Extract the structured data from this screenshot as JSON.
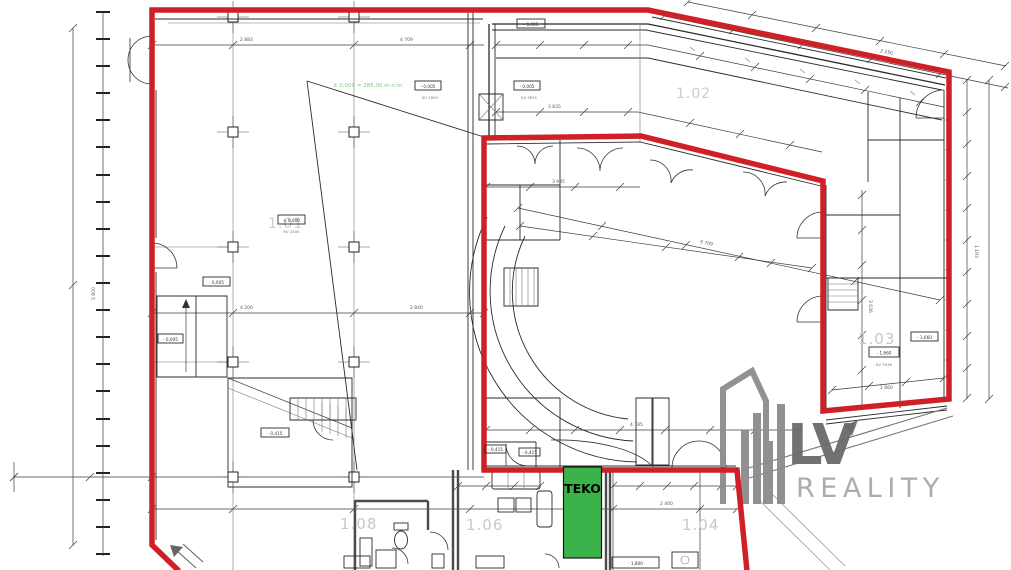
{
  "plan": {
    "note_green": "± 0,000 = 285,00 m n.m.",
    "rooms": {
      "r101": "1.01",
      "r102": "1.02",
      "r103": "1.03",
      "r104": "1.04",
      "r106": "1.06",
      "r108": "1.08"
    },
    "teko": {
      "label": "TEKO"
    },
    "elevations": {
      "e0": "- 0,005",
      "e1": "- 0,005",
      "e2": "- 0,415",
      "e3": "± 0,000",
      "kv3": "KV 2400",
      "e4": "- 0,005",
      "e5": "- 0,005",
      "kv5": "KV 3835",
      "e6": "- 0,005",
      "kv6": "KV 2800",
      "e7": "- 1,660",
      "kv7": "KV 3036",
      "e8": "- 1,660",
      "e9": "- 0,415",
      "e10": "- 0,415",
      "e11": "- 1,800"
    },
    "dims": [
      "2 883",
      "4 709",
      "4 200",
      "2 840",
      "3 985",
      "6 709",
      "4 785",
      "2 250",
      "3 036",
      "1 193",
      "5 800",
      "2 400",
      "3 835",
      "1 660"
    ],
    "watermark": {
      "brand": "LV",
      "suffix": "REALITY"
    },
    "colors": {
      "outline_red": "#cf2027",
      "teko_green": "#3cb24a",
      "label_gray": "#c8c8c8",
      "watermark_dark": "#6b6b6b",
      "watermark_mid": "#8c8c8c",
      "watermark_light": "#a8a8a8"
    }
  }
}
